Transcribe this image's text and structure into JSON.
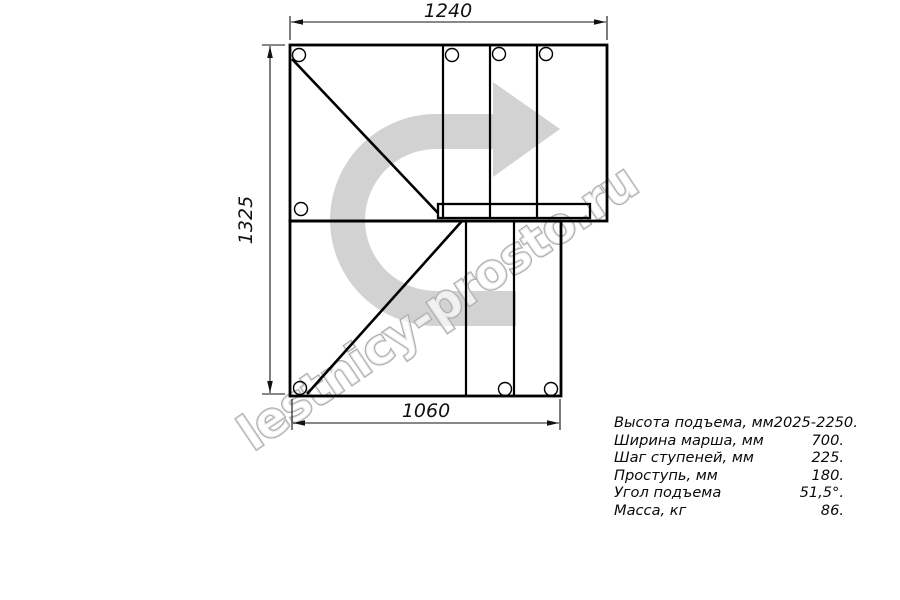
{
  "drawing": {
    "title": "staircase-plan-view",
    "dimensions": {
      "top": "1240",
      "left": "1325",
      "bottom": "1060"
    }
  },
  "watermark": {
    "text": "lestnicy-prosto.ru",
    "arrow_color": "#d2d2d2",
    "text_outline_color": "#ababab"
  },
  "specs": {
    "rows": [
      {
        "label": "Высота подъема, мм",
        "value": "2025-2250."
      },
      {
        "label": "Ширина марша, мм",
        "value": "700."
      },
      {
        "label": "Шаг ступеней, мм",
        "value": "225."
      },
      {
        "label": "Проступь, мм",
        "value": "180."
      },
      {
        "label": "Угол подъема",
        "value": "51,5°."
      },
      {
        "label": "Масса, кг",
        "value": "86."
      }
    ]
  },
  "colors": {
    "line": "#000000",
    "background": "#ffffff"
  }
}
